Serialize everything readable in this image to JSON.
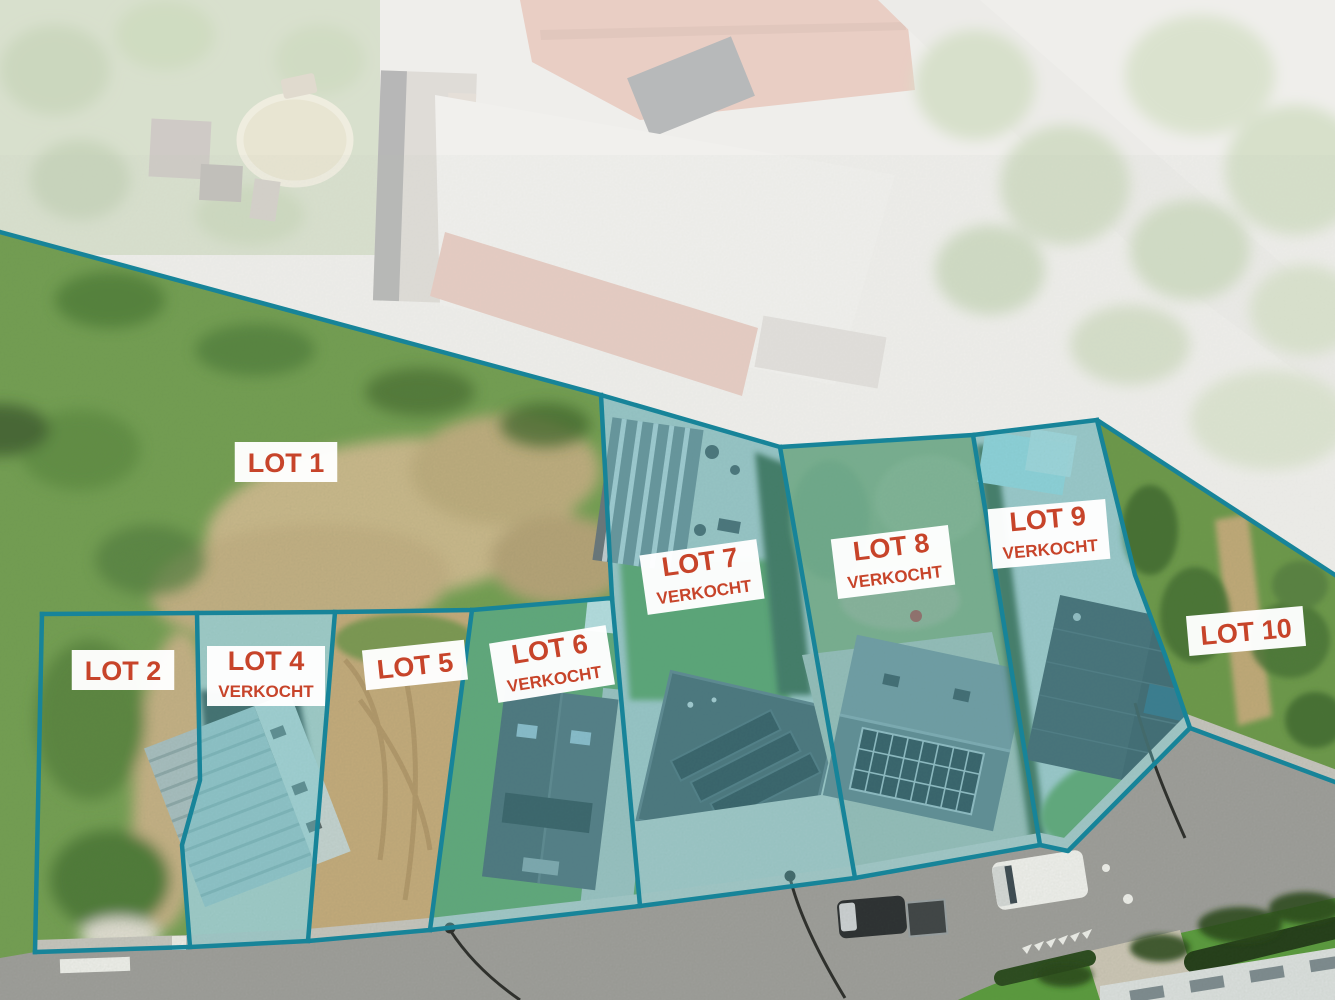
{
  "map": {
    "title": "Verkaveling luchtfoto met loten",
    "accent_color": "#178499",
    "sold_fill_color": "#63c8d2",
    "sold_fill_opacity": 0.38,
    "label_bg_color": "#ffffff",
    "label_text_color": "#c7442a",
    "lots": [
      {
        "id": "lot-1",
        "name": "LOT 1",
        "status": "",
        "sold": false,
        "polygon": [
          [
            0,
            232
          ],
          [
            601,
            395
          ],
          [
            612,
            598
          ],
          [
            472,
            610
          ],
          [
            42,
            614
          ],
          [
            0,
            616
          ]
        ],
        "label": {
          "x": 286,
          "y": 462,
          "rot": 0
        }
      },
      {
        "id": "lot-2",
        "name": "LOT 2",
        "status": "",
        "sold": false,
        "polygon": [
          [
            42,
            614
          ],
          [
            197,
            613
          ],
          [
            200,
            780
          ],
          [
            182,
            845
          ],
          [
            190,
            947
          ],
          [
            35,
            952
          ]
        ],
        "label": {
          "x": 123,
          "y": 670,
          "rot": 0
        }
      },
      {
        "id": "lot-4",
        "name": "LOT 4",
        "status": "VERKOCHT",
        "sold": true,
        "polygon": [
          [
            197,
            613
          ],
          [
            335,
            612
          ],
          [
            308,
            941
          ],
          [
            190,
            947
          ],
          [
            182,
            845
          ],
          [
            200,
            780
          ]
        ],
        "label": {
          "x": 266,
          "y": 676,
          "rot": 0
        }
      },
      {
        "id": "lot-5",
        "name": "LOT 5",
        "status": "",
        "sold": false,
        "polygon": [
          [
            335,
            612
          ],
          [
            472,
            610
          ],
          [
            430,
            930
          ],
          [
            308,
            941
          ]
        ],
        "label": {
          "x": 415,
          "y": 665,
          "rot": -6
        }
      },
      {
        "id": "lot-6",
        "name": "LOT 6",
        "status": "VERKOCHT",
        "sold": true,
        "polygon": [
          [
            472,
            610
          ],
          [
            612,
            598
          ],
          [
            640,
            906
          ],
          [
            430,
            930
          ]
        ],
        "label": {
          "x": 552,
          "y": 664,
          "rot": -9
        }
      },
      {
        "id": "lot-7",
        "name": "LOT 7",
        "status": "VERKOCHT",
        "sold": true,
        "polygon": [
          [
            601,
            395
          ],
          [
            780,
            447
          ],
          [
            855,
            878
          ],
          [
            640,
            906
          ],
          [
            612,
            598
          ]
        ],
        "label": {
          "x": 702,
          "y": 577,
          "rot": -8
        }
      },
      {
        "id": "lot-8",
        "name": "LOT 8",
        "status": "VERKOCHT",
        "sold": true,
        "polygon": [
          [
            780,
            447
          ],
          [
            973,
            435
          ],
          [
            1040,
            845
          ],
          [
            855,
            878
          ]
        ],
        "label": {
          "x": 893,
          "y": 562,
          "rot": -7
        }
      },
      {
        "id": "lot-9",
        "name": "LOT 9",
        "status": "VERKOCHT",
        "sold": true,
        "polygon": [
          [
            973,
            435
          ],
          [
            1097,
            420
          ],
          [
            1135,
            575
          ],
          [
            1165,
            655
          ],
          [
            1190,
            728
          ],
          [
            1068,
            851
          ],
          [
            1040,
            845
          ]
        ],
        "label": {
          "x": 1049,
          "y": 534,
          "rot": -5
        }
      },
      {
        "id": "lot-10",
        "name": "LOT 10",
        "status": "",
        "sold": false,
        "polygon": [
          [
            1097,
            420
          ],
          [
            1335,
            575
          ],
          [
            1335,
            782
          ],
          [
            1190,
            728
          ],
          [
            1165,
            655
          ],
          [
            1135,
            575
          ]
        ],
        "label": {
          "x": 1246,
          "y": 631,
          "rot": -5
        }
      }
    ],
    "boundary_lines": [
      {
        "id": "site-north-boundary",
        "points": [
          [
            0,
            232
          ],
          [
            601,
            395
          ],
          [
            780,
            447
          ],
          [
            973,
            435
          ],
          [
            1097,
            420
          ],
          [
            1335,
            575
          ]
        ]
      },
      {
        "id": "road-side-boundary",
        "points": [
          [
            35,
            952
          ],
          [
            190,
            947
          ],
          [
            308,
            941
          ],
          [
            430,
            930
          ],
          [
            640,
            906
          ],
          [
            855,
            878
          ],
          [
            1040,
            845
          ],
          [
            1068,
            851
          ],
          [
            1190,
            728
          ],
          [
            1335,
            782
          ]
        ]
      },
      {
        "id": "lot2-west-boundary",
        "points": [
          [
            42,
            614
          ],
          [
            35,
            952
          ]
        ]
      },
      {
        "id": "lots-north-row-boundary",
        "points": [
          [
            42,
            614
          ],
          [
            197,
            613
          ],
          [
            335,
            612
          ],
          [
            472,
            610
          ],
          [
            612,
            598
          ]
        ]
      },
      {
        "id": "divider-lot2-lot4",
        "points": [
          [
            197,
            613
          ],
          [
            200,
            780
          ],
          [
            182,
            845
          ],
          [
            190,
            947
          ]
        ]
      },
      {
        "id": "divider-lot4-lot5",
        "points": [
          [
            335,
            612
          ],
          [
            308,
            941
          ]
        ]
      },
      {
        "id": "divider-lot5-lot6",
        "points": [
          [
            472,
            610
          ],
          [
            430,
            930
          ]
        ]
      },
      {
        "id": "divider-lot6-lot7",
        "points": [
          [
            601,
            395
          ],
          [
            612,
            598
          ],
          [
            640,
            906
          ]
        ]
      },
      {
        "id": "divider-lot7-lot8",
        "points": [
          [
            780,
            447
          ],
          [
            855,
            878
          ]
        ]
      },
      {
        "id": "divider-lot8-lot9",
        "points": [
          [
            973,
            435
          ],
          [
            1040,
            845
          ]
        ]
      },
      {
        "id": "divider-lot9-lot10",
        "points": [
          [
            1097,
            420
          ],
          [
            1135,
            575
          ],
          [
            1165,
            655
          ],
          [
            1190,
            728
          ]
        ]
      }
    ],
    "faded_region": [
      [
        0,
        0
      ],
      [
        1335,
        0
      ],
      [
        1335,
        575
      ],
      [
        1097,
        420
      ],
      [
        973,
        435
      ],
      [
        780,
        447
      ],
      [
        601,
        395
      ],
      [
        0,
        232
      ]
    ]
  }
}
